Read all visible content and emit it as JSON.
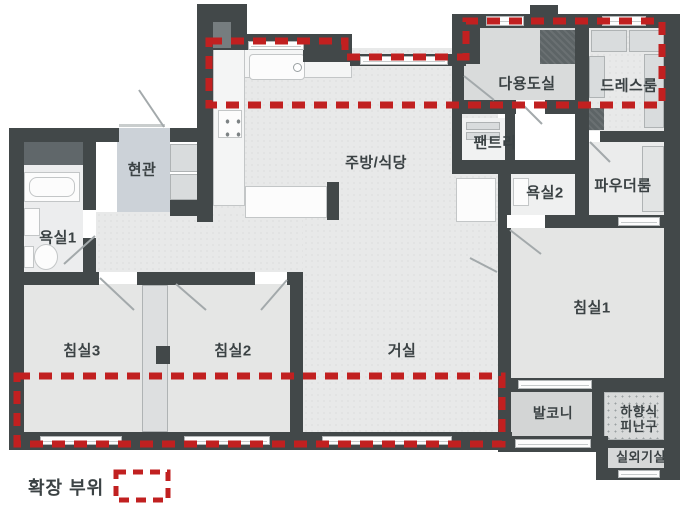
{
  "plan": {
    "title": "apartment-floor-plan",
    "legend": {
      "label": "확장 부위"
    },
    "colors": {
      "wall": "#424849",
      "floor": "#e8e9e9",
      "entrance_floor": "#ccd2d8",
      "balcony_floor": "#d3d5d5",
      "expansion_red": "#c12020",
      "label_text": "#3b4244"
    },
    "rooms": [
      {
        "id": "entrance",
        "label": "현관",
        "x": 142,
        "y": 170,
        "fs": 15
      },
      {
        "id": "bath1",
        "label": "욕실1",
        "x": 58,
        "y": 238,
        "fs": 15
      },
      {
        "id": "bedroom3",
        "label": "침실3",
        "x": 82,
        "y": 351,
        "fs": 15
      },
      {
        "id": "bedroom2",
        "label": "침실2",
        "x": 233,
        "y": 351,
        "fs": 15
      },
      {
        "id": "living",
        "label": "거실",
        "x": 402,
        "y": 351,
        "fs": 15
      },
      {
        "id": "kitchen",
        "label": "주방/식당",
        "x": 376,
        "y": 163,
        "fs": 15
      },
      {
        "id": "utility",
        "label": "다용도실",
        "x": 527,
        "y": 84,
        "fs": 15
      },
      {
        "id": "dressroom",
        "label": "드레스룸",
        "x": 629,
        "y": 86,
        "fs": 15
      },
      {
        "id": "pantry",
        "label": "팬트리",
        "x": 495,
        "y": 143,
        "fs": 15
      },
      {
        "id": "bath2",
        "label": "욕실2",
        "x": 545,
        "y": 193,
        "fs": 15
      },
      {
        "id": "powder",
        "label": "파우더룸",
        "x": 623,
        "y": 186,
        "fs": 15
      },
      {
        "id": "bedroom1",
        "label": "침실1",
        "x": 592,
        "y": 308,
        "fs": 15
      },
      {
        "id": "balcony",
        "label": "발코니",
        "x": 553,
        "y": 413,
        "fs": 14
      },
      {
        "id": "evacuation",
        "label": "하향식\n피난구",
        "x": 639,
        "y": 420,
        "fs": 13
      },
      {
        "id": "outdoor-unit",
        "label": "실외기실",
        "x": 641,
        "y": 458,
        "fs": 13
      }
    ]
  }
}
